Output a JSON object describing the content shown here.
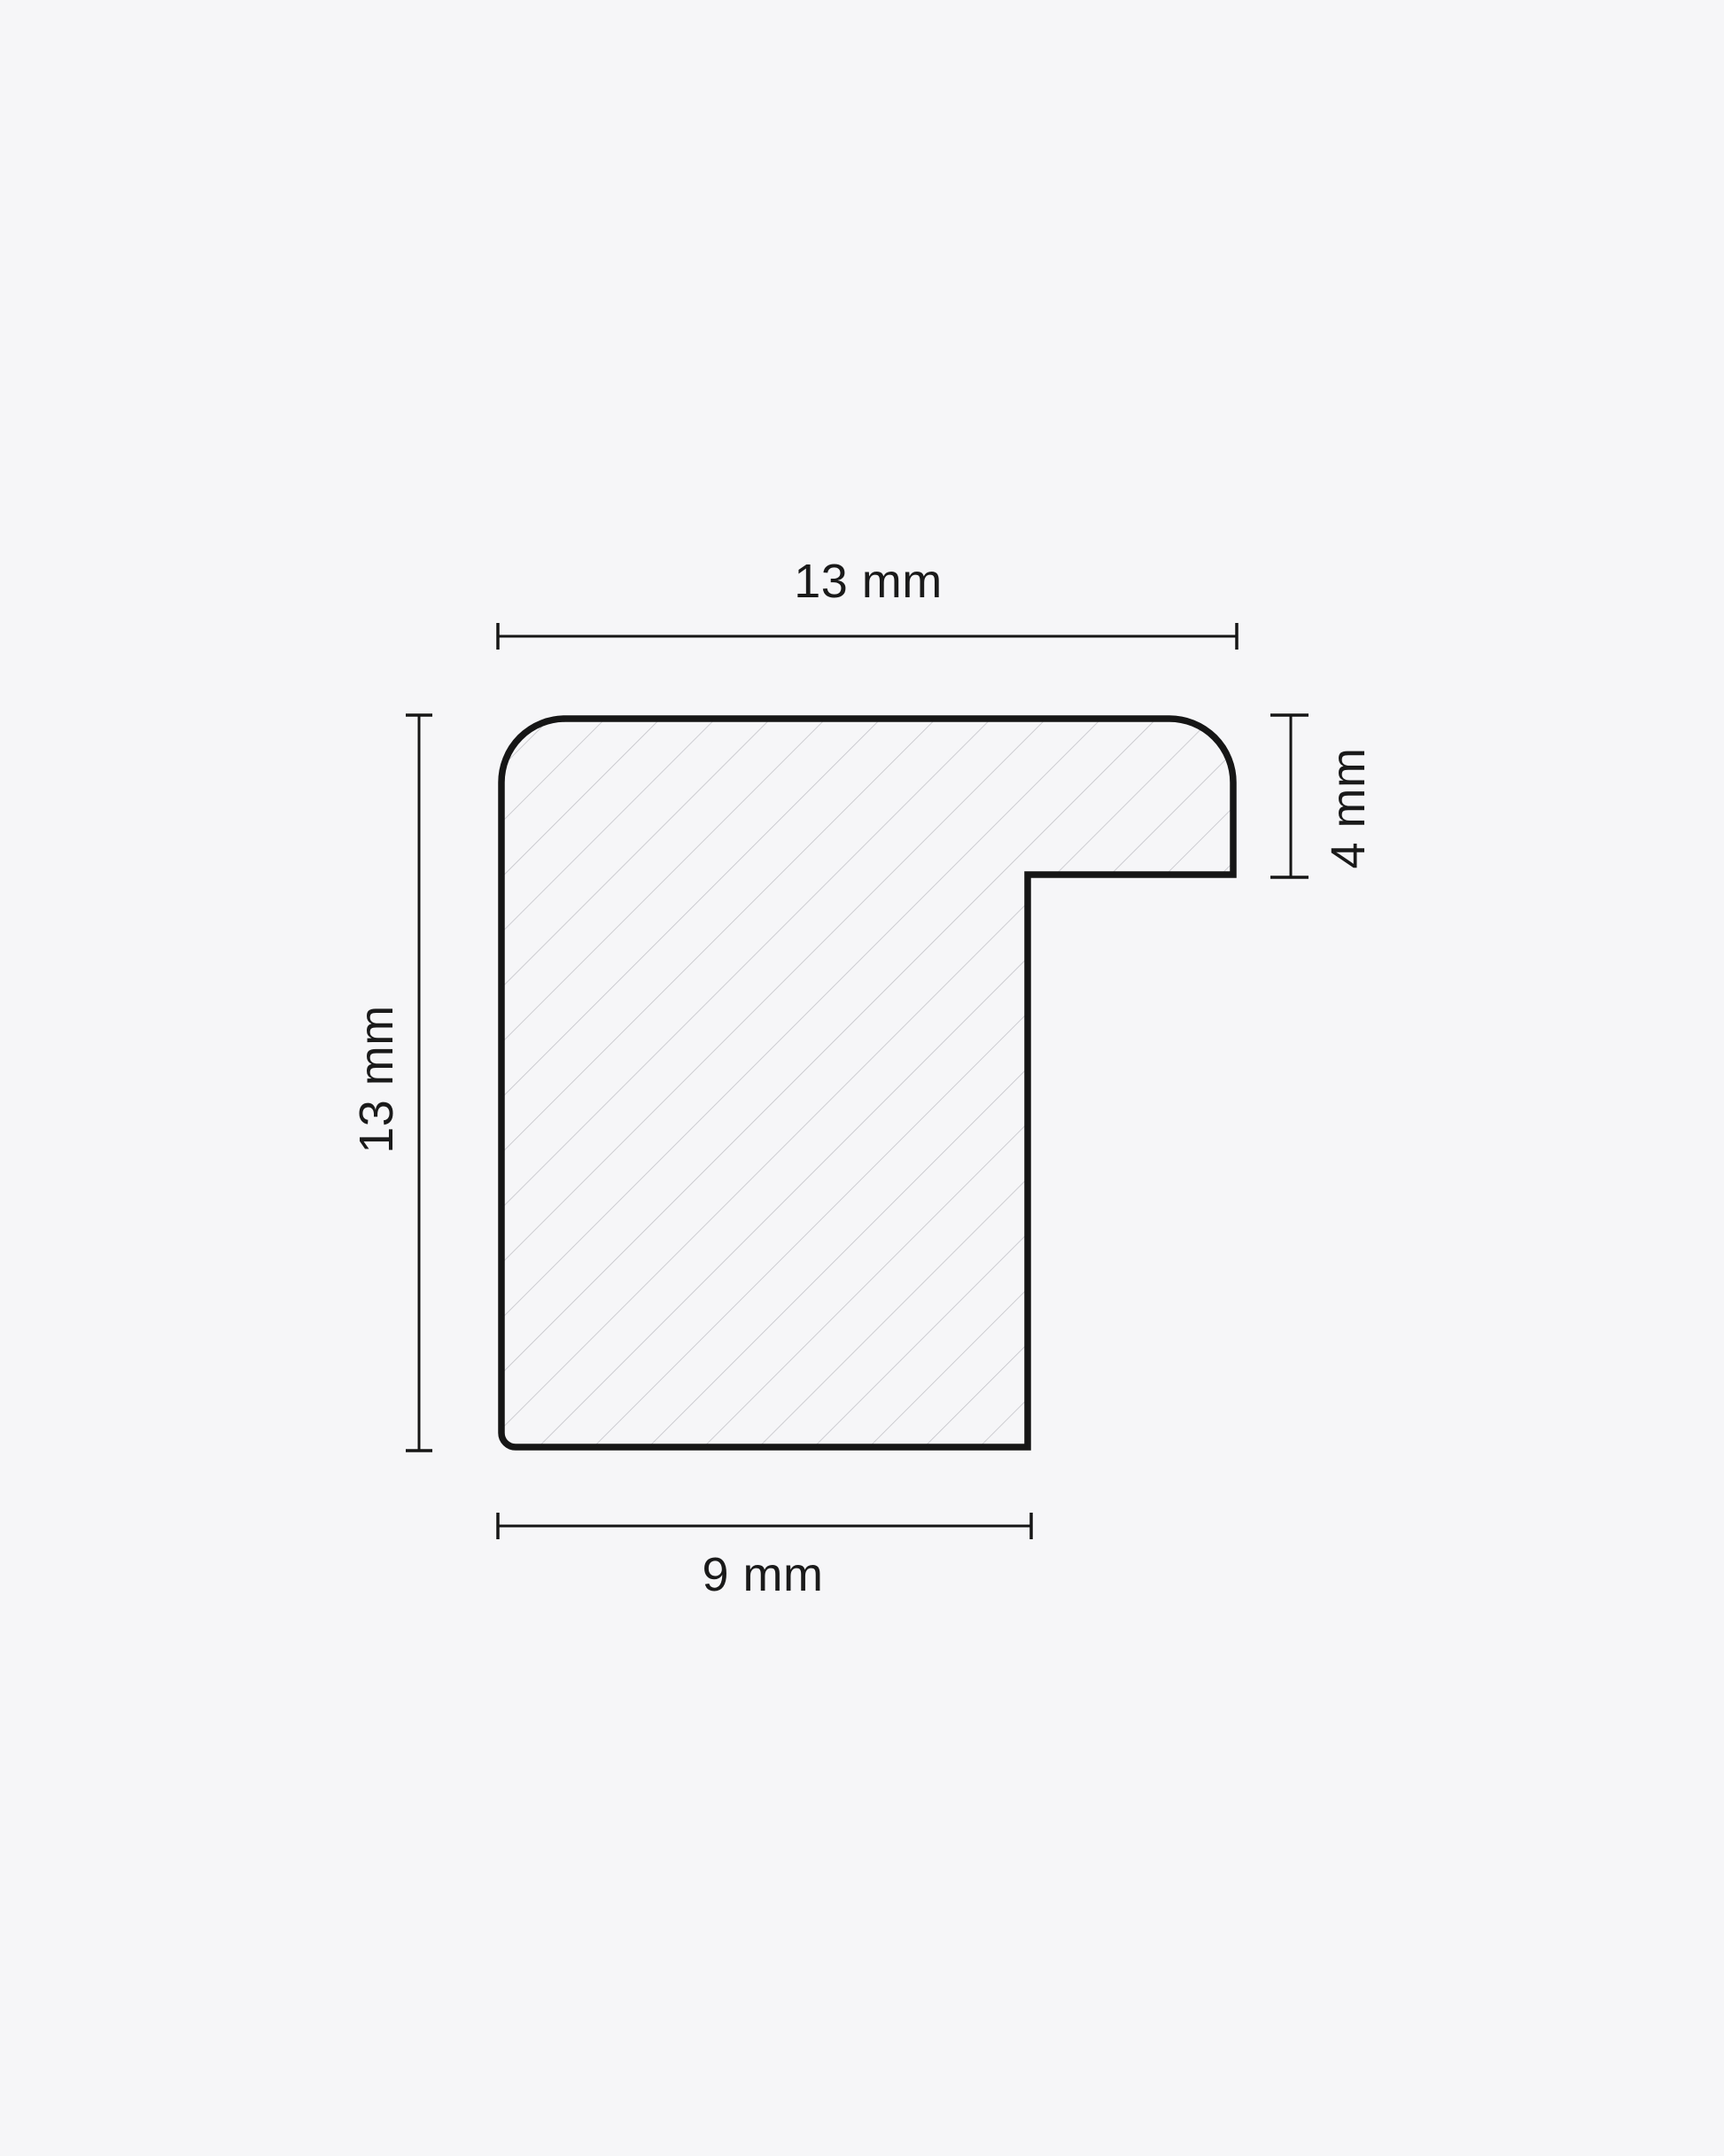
{
  "drawing": {
    "type": "profile-cross-section",
    "dimensions": {
      "top": {
        "label": "13 mm"
      },
      "left": {
        "label": "13 mm"
      },
      "right": {
        "label": "4 mm"
      },
      "bottom": {
        "label": "9 mm"
      }
    },
    "colors": {
      "background": "#f6f6f8",
      "outline": "#161616",
      "dimension": "#161616",
      "hatch": "#c2c2c7",
      "text": "#1a1a1a"
    }
  }
}
